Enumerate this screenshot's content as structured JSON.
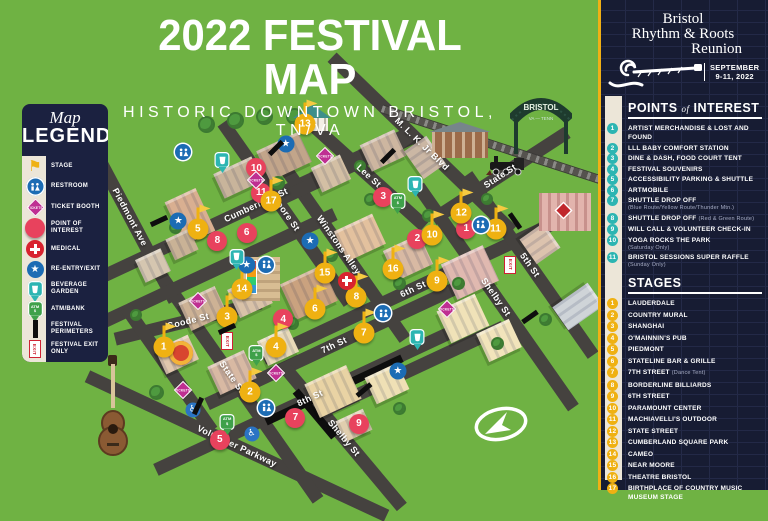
{
  "title": {
    "line1": "2022 FESTIVAL MAP",
    "line2": "HISTORIC DOWNTOWN BRISTOL, TN/VA"
  },
  "legend": {
    "title_script": "Map",
    "title_main": "LEGEND",
    "items": [
      {
        "icon": "stage",
        "label": "STAGE"
      },
      {
        "icon": "rr",
        "label": "RESTROOM"
      },
      {
        "icon": "tik",
        "label": "TICKET BOOTH"
      },
      {
        "icon": "poi",
        "label": "POINT OF INTEREST"
      },
      {
        "icon": "med",
        "label": "MEDICAL"
      },
      {
        "icon": "star",
        "label": "RE-ENTRY/EXIT"
      },
      {
        "icon": "bev",
        "label": "BEVERAGE GARDEN"
      },
      {
        "icon": "atm",
        "label": "ATM/BANK"
      },
      {
        "icon": "bar",
        "label": "FESTIVAL PERIMETERS"
      },
      {
        "icon": "exit",
        "label": "FESTIVAL EXIT ONLY"
      }
    ]
  },
  "panel": {
    "logo": {
      "line1": "Bristol",
      "line2": "Rhythm & Roots",
      "line3": "Reunion",
      "date_line1": "SEPTEMBER",
      "date_line2": "9-11, 2022"
    },
    "poi_header": {
      "w1": "POINTS",
      "w2": "of",
      "w3": "INTEREST"
    },
    "poi_items": [
      {
        "n": "1",
        "label": "ARTIST MERCHANDISE & LOST AND FOUND"
      },
      {
        "n": "2",
        "label": "LLL BABY COMFORT STATION"
      },
      {
        "n": "3",
        "label": "DINE & DASH, FOOD COURT TENT"
      },
      {
        "n": "4",
        "label": "FESTIVAL SOUVENIRS"
      },
      {
        "n": "5",
        "label": "ACCESSIBILITY PARKING & SHUTTLE"
      },
      {
        "n": "6",
        "label": "ARTMOBILE"
      },
      {
        "n": "7",
        "label": "SHUTTLE DROP OFF",
        "note": "(Blue Route/Yellow Route/Thunder Mtn.)"
      },
      {
        "n": "8",
        "label": "SHUTTLE DROP OFF",
        "inline_note": "(Red & Green Route)"
      },
      {
        "n": "9",
        "label": "WILL CALL & VOLUNTEER CHECK-IN"
      },
      {
        "n": "10",
        "label": "YOGA ROCKS THE PARK",
        "note": "(Saturday Only)"
      },
      {
        "n": "11",
        "label": "BRISTOL SESSIONS SUPER RAFFLE",
        "note": "(Sunday Only)"
      }
    ],
    "stages_header": "STAGES",
    "stage_items": [
      {
        "n": "1",
        "label": "LAUDERDALE"
      },
      {
        "n": "2",
        "label": "COUNTRY MURAL"
      },
      {
        "n": "3",
        "label": "SHANGHAI"
      },
      {
        "n": "4",
        "label": "O'MAINNIN'S PUB"
      },
      {
        "n": "5",
        "label": "PIEDMONT"
      },
      {
        "n": "6",
        "label": "STATELINE BAR & GRILLE"
      },
      {
        "n": "7",
        "label": "7TH STREET",
        "inline_note": "(Dance Tent)"
      },
      {
        "n": "8",
        "label": "BORDERLINE BILLIARDS"
      },
      {
        "n": "9",
        "label": "6TH STREET"
      },
      {
        "n": "10",
        "label": "PARAMOUNT CENTER"
      },
      {
        "n": "11",
        "label": "MACHIAVELLI'S OUTDOOR"
      },
      {
        "n": "12",
        "label": "STATE STREET"
      },
      {
        "n": "13",
        "label": "CUMBERLAND SQUARE PARK"
      },
      {
        "n": "14",
        "label": "CAMEO"
      },
      {
        "n": "15",
        "label": "NEAR MOORE"
      },
      {
        "n": "16",
        "label": "THEATRE BRISTOL"
      },
      {
        "n": "17",
        "label": "BIRTHPLACE OF COUNTRY MUSIC MUSEUM STAGE"
      }
    ]
  },
  "map": {
    "bristol_sign_line1": "BRISTOL",
    "bristol_sign_line2": "VA — TENN",
    "streets": [
      {
        "name": "Cumberland St",
        "x": 30,
        "y": 29,
        "len": 340,
        "a": -25
      },
      {
        "name": "Goode St",
        "x": 16,
        "y": 58,
        "len": 150,
        "a": -14
      },
      {
        "name": "7th St",
        "x": 46,
        "y": 64,
        "len": 280,
        "a": -25
      },
      {
        "name": "8th St",
        "x": 41,
        "y": 77,
        "len": 340,
        "a": -25
      },
      {
        "name": "6th St",
        "x": 62,
        "y": 50,
        "len": 330,
        "a": -25
      },
      {
        "name": "Volunteer Parkway",
        "x": 26,
        "y": 89,
        "len": 330,
        "a": 25
      },
      {
        "name": "M. L. K. Jr Blvd",
        "x": 64,
        "y": 14,
        "len": 250,
        "a": 44
      },
      {
        "name": "State St",
        "x": 80,
        "y": 22,
        "len": 160,
        "a": -33
      },
      {
        "name": "Piedmont Ave",
        "x": 4,
        "y": 32,
        "len": 190,
        "a": 62
      },
      {
        "name": "Moore St",
        "x": 36,
        "y": 31,
        "len": 220,
        "a": 55
      },
      {
        "name": "Winstons Alley",
        "x": 47,
        "y": 39,
        "len": 230,
        "a": 55
      },
      {
        "name": "State St",
        "x": 25,
        "y": 72,
        "len": 300,
        "a": 55
      },
      {
        "name": "Lee St",
        "x": 53,
        "y": 22,
        "len": 150,
        "a": 42
      },
      {
        "name": "Shelby St",
        "x": 79,
        "y": 52,
        "len": 270,
        "a": 55
      },
      {
        "name": "Shelby St",
        "x": 48,
        "y": 87,
        "len": 180,
        "a": 50
      },
      {
        "name": "5th St",
        "x": 86,
        "y": 44,
        "len": 220,
        "a": 55
      },
      {
        "name": "",
        "x": 22,
        "y": 45,
        "len": 260,
        "a": -25
      },
      {
        "name": "",
        "x": 45,
        "y": 22,
        "len": 180,
        "a": -25
      },
      {
        "name": "",
        "x": 62,
        "y": 70,
        "len": 200,
        "a": -25
      },
      {
        "name": "",
        "x": 12,
        "y": 70,
        "len": 150,
        "a": 55
      },
      {
        "name": "",
        "x": 46,
        "y": 75,
        "len": 150,
        "a": -25,
        "perim": true
      },
      {
        "name": "",
        "x": 42,
        "y": 81,
        "len": 60,
        "a": 50,
        "perim": true
      },
      {
        "name": "",
        "x": 83,
        "y": 16,
        "len": 280,
        "a": 18,
        "rail": true
      }
    ],
    "markers": [
      {
        "kind": "poi",
        "n": "1",
        "x": 73,
        "y": 35
      },
      {
        "kind": "poi",
        "n": "2",
        "x": 63,
        "y": 37.5
      },
      {
        "kind": "poi",
        "n": "3",
        "x": 56,
        "y": 27
      },
      {
        "kind": "poi",
        "n": "4",
        "x": 35.5,
        "y": 57.5
      },
      {
        "kind": "poi",
        "n": "5",
        "x": 22.5,
        "y": 87.5
      },
      {
        "kind": "poi",
        "n": "6",
        "x": 28,
        "y": 36
      },
      {
        "kind": "poi",
        "n": "7",
        "x": 38,
        "y": 82
      },
      {
        "kind": "poi",
        "n": "8",
        "x": 22,
        "y": 38
      },
      {
        "kind": "poi",
        "n": "9",
        "x": 51,
        "y": 83.5
      },
      {
        "kind": "poi",
        "n": "10",
        "x": 30,
        "y": 20
      },
      {
        "kind": "poi",
        "n": "11",
        "x": 31,
        "y": 26
      },
      {
        "kind": "stage",
        "n": "1",
        "x": 11,
        "y": 64.5
      },
      {
        "kind": "stage",
        "n": "2",
        "x": 28.7,
        "y": 75.5
      },
      {
        "kind": "stage",
        "n": "3",
        "x": 24,
        "y": 57
      },
      {
        "kind": "stage",
        "n": "4",
        "x": 34,
        "y": 64.5
      },
      {
        "kind": "stage",
        "n": "5",
        "x": 18,
        "y": 35
      },
      {
        "kind": "stage",
        "n": "6",
        "x": 42,
        "y": 55
      },
      {
        "kind": "stage",
        "n": "7",
        "x": 52,
        "y": 61
      },
      {
        "kind": "stage",
        "n": "8",
        "x": 50.5,
        "y": 52
      },
      {
        "kind": "stage",
        "n": "9",
        "x": 67,
        "y": 48
      },
      {
        "kind": "stage",
        "n": "10",
        "x": 66,
        "y": 36.5
      },
      {
        "kind": "stage",
        "n": "11",
        "x": 79,
        "y": 35
      },
      {
        "kind": "stage",
        "n": "12",
        "x": 72,
        "y": 31
      },
      {
        "kind": "stage",
        "n": "13",
        "x": 40,
        "y": 9
      },
      {
        "kind": "stage",
        "n": "14",
        "x": 27,
        "y": 50
      },
      {
        "kind": "stage",
        "n": "15",
        "x": 44,
        "y": 46
      },
      {
        "kind": "stage",
        "n": "16",
        "x": 58,
        "y": 45
      },
      {
        "kind": "stage",
        "n": "17",
        "x": 33,
        "y": 28
      },
      {
        "kind": "rr",
        "x": 15,
        "y": 16
      },
      {
        "kind": "rr",
        "x": 76,
        "y": 34
      },
      {
        "kind": "rr",
        "x": 32,
        "y": 44
      },
      {
        "kind": "rr",
        "x": 56,
        "y": 56
      },
      {
        "kind": "rr",
        "x": 32,
        "y": 79.5
      },
      {
        "kind": "star",
        "x": 14,
        "y": 33
      },
      {
        "kind": "star",
        "x": 36,
        "y": 14
      },
      {
        "kind": "star",
        "x": 41,
        "y": 38
      },
      {
        "kind": "star",
        "x": 28,
        "y": 44
      },
      {
        "kind": "star",
        "x": 59,
        "y": 70.5
      },
      {
        "kind": "bev",
        "x": 23,
        "y": 18
      },
      {
        "kind": "bev",
        "x": 62.5,
        "y": 24
      },
      {
        "kind": "bev",
        "x": 26,
        "y": 42
      },
      {
        "kind": "bev",
        "x": 63,
        "y": 62
      },
      {
        "kind": "atm",
        "x": 59,
        "y": 28
      },
      {
        "kind": "atm",
        "x": 30,
        "y": 66
      },
      {
        "kind": "atm",
        "x": 24,
        "y": 83
      },
      {
        "kind": "med",
        "x": 48.5,
        "y": 48
      },
      {
        "kind": "tik",
        "x": 44,
        "y": 17
      },
      {
        "kind": "tik",
        "x": 30,
        "y": 23
      },
      {
        "kind": "tik",
        "x": 18,
        "y": 53
      },
      {
        "kind": "tik",
        "x": 15,
        "y": 75
      },
      {
        "kind": "tik",
        "x": 34,
        "y": 71
      },
      {
        "kind": "tik",
        "x": 69,
        "y": 55
      },
      {
        "kind": "exit",
        "x": 24,
        "y": 63
      },
      {
        "kind": "exit",
        "x": 82,
        "y": 44
      },
      {
        "kind": "acc",
        "x": 17,
        "y": 80
      },
      {
        "kind": "acc",
        "x": 29,
        "y": 86
      },
      {
        "kind": "bar",
        "x": 10,
        "y": 33,
        "r": 65
      },
      {
        "kind": "bar",
        "x": 34,
        "y": 15,
        "r": 45
      },
      {
        "kind": "bar",
        "x": 57,
        "y": 17,
        "r": 45
      },
      {
        "kind": "bar",
        "x": 83,
        "y": 33,
        "r": -35
      },
      {
        "kind": "bar",
        "x": 24,
        "y": 60,
        "r": 65
      },
      {
        "kind": "bar",
        "x": 18,
        "y": 79,
        "r": 25
      },
      {
        "kind": "bar",
        "x": 52,
        "y": 75,
        "r": 50
      },
      {
        "kind": "bar",
        "x": 86,
        "y": 57,
        "r": 55
      }
    ],
    "buildings": [
      [
        13,
        26,
        34,
        44,
        -25,
        "#d9af91"
      ],
      [
        22,
        19,
        42,
        24,
        -25,
        "#c8b49b"
      ],
      [
        31,
        13,
        46,
        30,
        -25,
        "#c2a58a"
      ],
      [
        42,
        18,
        32,
        24,
        -25,
        "#d3bfa4"
      ],
      [
        52,
        12,
        38,
        26,
        -25,
        "#cdb6a0"
      ],
      [
        6,
        41,
        28,
        22,
        -25,
        "#d5c6b0"
      ],
      [
        12,
        36,
        26,
        20,
        -25,
        "#c9b296"
      ],
      [
        47,
        33,
        42,
        30,
        -25,
        "#e3c19e"
      ],
      [
        57,
        38,
        40,
        30,
        -25,
        "#d8b9a3"
      ],
      [
        69,
        41,
        46,
        36,
        -25,
        "#e0b9b0"
      ],
      [
        36,
        46,
        46,
        36,
        -25,
        "#caa27f"
      ],
      [
        25,
        48,
        36,
        28,
        -25,
        "#d9c2a8"
      ],
      [
        15,
        51,
        40,
        28,
        -25,
        "#cdb295"
      ],
      [
        10,
        63,
        36,
        24,
        -25,
        "#e0c7ad"
      ],
      [
        21,
        67,
        40,
        28,
        -25,
        "#d8b9a3"
      ],
      [
        31,
        61,
        34,
        24,
        -25,
        "#e8d9b8"
      ],
      [
        41,
        71,
        46,
        34,
        -25,
        "#e9d3a4"
      ],
      [
        53,
        70,
        36,
        26,
        -25,
        "#efe0b5"
      ],
      [
        68,
        53,
        42,
        32,
        -25,
        "#f0e2b8"
      ],
      [
        76,
        59,
        36,
        28,
        -25,
        "#f2e4bb"
      ],
      [
        85,
        35,
        30,
        26,
        55,
        "#dcc3ae"
      ],
      [
        93,
        49,
        28,
        40,
        55,
        "#cfd4d8"
      ],
      [
        47,
        81,
        30,
        20,
        -25,
        "#e0ceae"
      ],
      [
        61,
        14,
        34,
        24,
        55,
        "#cbb7a4"
      ]
    ],
    "trees": [
      [
        18,
        7,
        13
      ],
      [
        24,
        6,
        13
      ],
      [
        30,
        5,
        13
      ],
      [
        36,
        5,
        13
      ],
      [
        33,
        22,
        10
      ],
      [
        52,
        26,
        9
      ],
      [
        64,
        30,
        9
      ],
      [
        12,
        33,
        9
      ],
      [
        44,
        40,
        9
      ],
      [
        58,
        47,
        9
      ],
      [
        22,
        56,
        9
      ],
      [
        36,
        57,
        9
      ],
      [
        70,
        47,
        9
      ],
      [
        78,
        62,
        9
      ],
      [
        8,
        74,
        11
      ],
      [
        58,
        78,
        9
      ],
      [
        88,
        56,
        9
      ],
      [
        50,
        18,
        8
      ],
      [
        76,
        26,
        8
      ],
      [
        4,
        55,
        8
      ]
    ]
  }
}
